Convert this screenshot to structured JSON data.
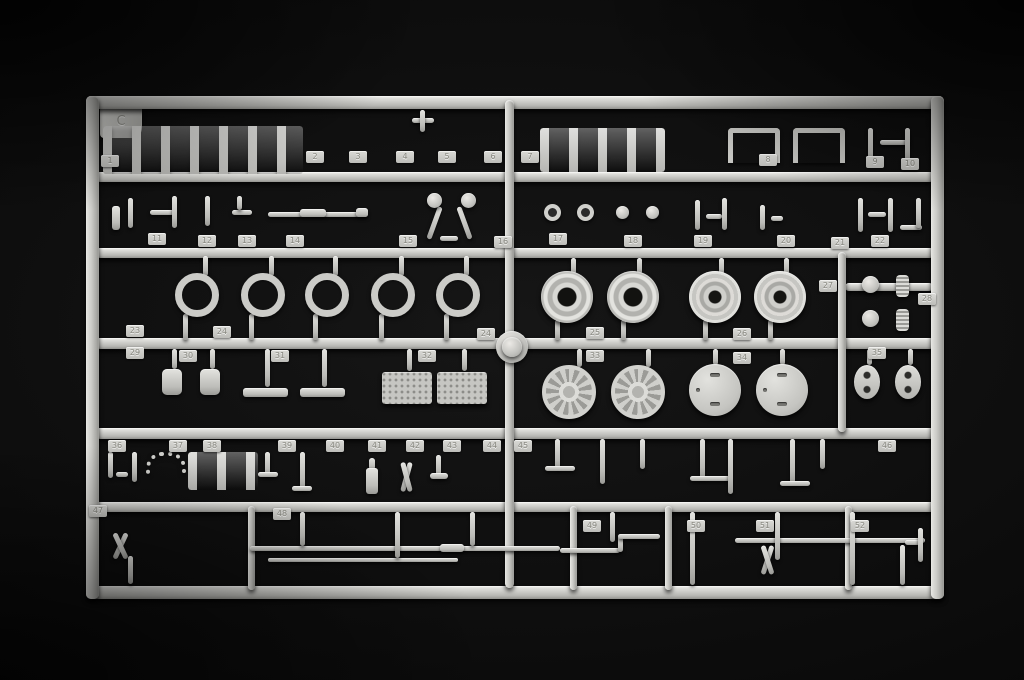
{
  "photo": {
    "subject": "Injection-molded model kit parts sprue (light grey styrene) photographed on a black background",
    "background_color": "#0c0c0c",
    "plastic_color": "#c7c7c3",
    "sprue_letter": "C"
  },
  "part_tabs": [
    {
      "label": "1",
      "x": 110,
      "y": 161
    },
    {
      "label": "2",
      "x": 315,
      "y": 157
    },
    {
      "label": "3",
      "x": 358,
      "y": 157
    },
    {
      "label": "4",
      "x": 405,
      "y": 157
    },
    {
      "label": "5",
      "x": 447,
      "y": 157
    },
    {
      "label": "6",
      "x": 493,
      "y": 157
    },
    {
      "label": "7",
      "x": 530,
      "y": 157
    },
    {
      "label": "8",
      "x": 768,
      "y": 160
    },
    {
      "label": "9",
      "x": 875,
      "y": 162
    },
    {
      "label": "10",
      "x": 910,
      "y": 164
    },
    {
      "label": "11",
      "x": 157,
      "y": 239
    },
    {
      "label": "12",
      "x": 207,
      "y": 241
    },
    {
      "label": "13",
      "x": 247,
      "y": 241
    },
    {
      "label": "14",
      "x": 295,
      "y": 241
    },
    {
      "label": "15",
      "x": 408,
      "y": 241
    },
    {
      "label": "16",
      "x": 503,
      "y": 242
    },
    {
      "label": "17",
      "x": 558,
      "y": 239
    },
    {
      "label": "18",
      "x": 633,
      "y": 241
    },
    {
      "label": "19",
      "x": 703,
      "y": 241
    },
    {
      "label": "20",
      "x": 786,
      "y": 241
    },
    {
      "label": "21",
      "x": 840,
      "y": 243
    },
    {
      "label": "22",
      "x": 880,
      "y": 241
    },
    {
      "label": "23",
      "x": 135,
      "y": 331
    },
    {
      "label": "24",
      "x": 222,
      "y": 332
    },
    {
      "label": "24",
      "x": 486,
      "y": 334
    },
    {
      "label": "25",
      "x": 595,
      "y": 333
    },
    {
      "label": "26",
      "x": 742,
      "y": 334
    },
    {
      "label": "27",
      "x": 828,
      "y": 286
    },
    {
      "label": "28",
      "x": 927,
      "y": 299
    },
    {
      "label": "29",
      "x": 135,
      "y": 353
    },
    {
      "label": "30",
      "x": 188,
      "y": 356
    },
    {
      "label": "31",
      "x": 280,
      "y": 356
    },
    {
      "label": "32",
      "x": 427,
      "y": 356
    },
    {
      "label": "33",
      "x": 595,
      "y": 356
    },
    {
      "label": "34",
      "x": 742,
      "y": 358
    },
    {
      "label": "35",
      "x": 877,
      "y": 353
    },
    {
      "label": "36",
      "x": 117,
      "y": 446
    },
    {
      "label": "37",
      "x": 178,
      "y": 446
    },
    {
      "label": "38",
      "x": 212,
      "y": 446
    },
    {
      "label": "39",
      "x": 287,
      "y": 446
    },
    {
      "label": "40",
      "x": 335,
      "y": 446
    },
    {
      "label": "41",
      "x": 377,
      "y": 446
    },
    {
      "label": "42",
      "x": 415,
      "y": 446
    },
    {
      "label": "43",
      "x": 452,
      "y": 446
    },
    {
      "label": "44",
      "x": 492,
      "y": 446
    },
    {
      "label": "45",
      "x": 523,
      "y": 446
    },
    {
      "label": "46",
      "x": 887,
      "y": 446
    },
    {
      "label": "47",
      "x": 98,
      "y": 511
    },
    {
      "label": "48",
      "x": 282,
      "y": 514
    },
    {
      "label": "49",
      "x": 592,
      "y": 526
    },
    {
      "label": "50",
      "x": 696,
      "y": 526
    },
    {
      "label": "51",
      "x": 765,
      "y": 526
    },
    {
      "label": "52",
      "x": 860,
      "y": 526
    }
  ]
}
